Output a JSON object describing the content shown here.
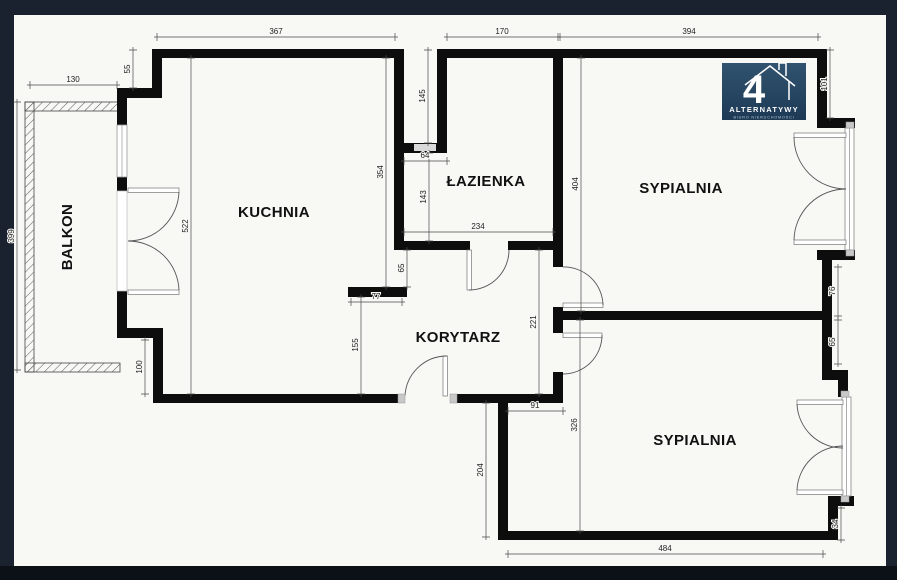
{
  "colors": {
    "frame": "#1a2230",
    "frame_bottom": "#0c1118",
    "plan": "#f8f8f5",
    "wall": "#0d0d0d",
    "line": "#4a4a4a",
    "dim_text": "#222222",
    "room_text": "#111111",
    "logo_top": "#31536f",
    "logo_bottom": "#1d3a55",
    "logo_text": "#ffffff",
    "logo_subtext": "#b9c9d8"
  },
  "logo": {
    "number": "4",
    "title": "ALTERNATYWY",
    "subtitle": "BIURO NIERUCHOMOŚCI"
  },
  "rooms": {
    "balkon": "BALKON",
    "kuchnia": "KUCHNIA",
    "lazienka": "ŁAZIENKA",
    "sypialnia_top": "SYPIALNIA",
    "korytarz": "KORYTARZ",
    "sypialnia_bottom": "SYPIALNIA"
  },
  "dims": {
    "kuchnia_top": "367",
    "lazienka_top": "170",
    "sypialnia_top_width": "394",
    "balkon_top": "130",
    "step_top": "55",
    "balkon_left": "399",
    "kuchnia_left": "522",
    "kuchnia_right": "354",
    "shaft_height": "145",
    "shaft_width": "64",
    "lazienka_left": "143",
    "lazienka_bottom": "234",
    "kuchnia_opening": "65",
    "stub_width": "77",
    "korytarz_left": "155",
    "step_bottom": "100",
    "sypialnia_top_height": "404",
    "korytarz_right": "221",
    "door_offset": "91",
    "sypialnia_bottom_height": "326",
    "sypialnia_bottom_left": "204",
    "sypialnia_bottom_width": "484",
    "window_offset_top": "101",
    "pier_top": "76",
    "pier_bottom": "65",
    "window_offset_bottom": "34"
  }
}
